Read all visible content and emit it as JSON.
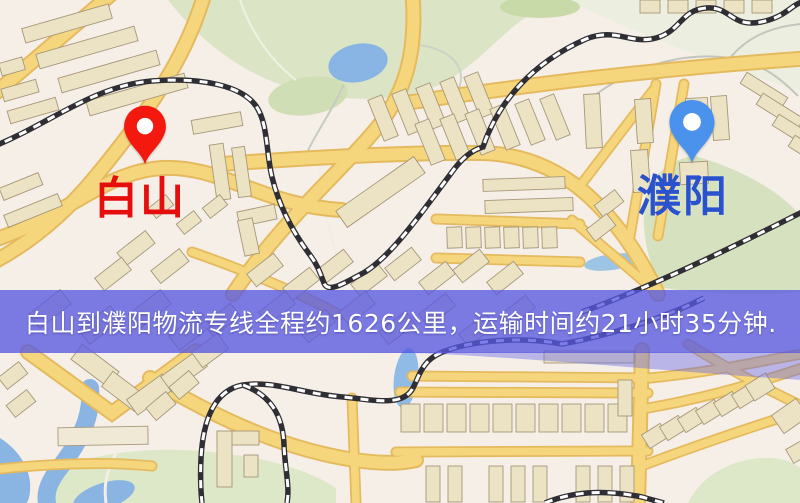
{
  "banner": {
    "text": "白山到濮阳物流专线全程约1626公里，运输时间约21小时35分钟.",
    "bg_color": "rgba(88,88,226,0.78)",
    "text_color": "#ffffff"
  },
  "markers": {
    "origin": {
      "label": "白山",
      "pin_color": "#f3190f",
      "label_color": "#e60d0d"
    },
    "destination": {
      "label": "濮阳",
      "pin_color": "#4b92ec",
      "label_color": "#2b52cd"
    }
  },
  "map_palette": {
    "base": "#f6efe8",
    "road_fill": "#f6d67d",
    "road_casing": "#e5ba5e",
    "building_fill": "#ece2c4",
    "building_stroke": "#a6987a",
    "greenery": "#dbe5c6",
    "water": "#88b5e3",
    "railway_dark": "#2e2e34",
    "railway_dash": "#ffffff"
  }
}
